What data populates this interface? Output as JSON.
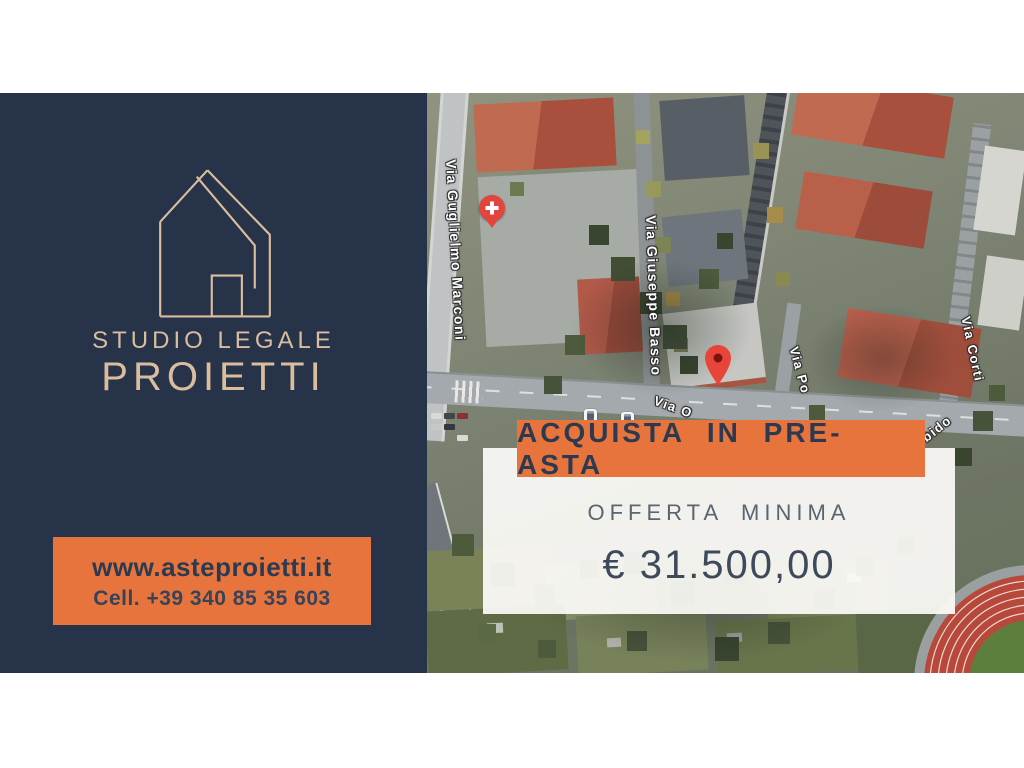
{
  "brand": {
    "title1": "STUDIO LEGALE",
    "title2": "PROIETTI",
    "website": "www.asteproietti.it",
    "phone": "Cell. +39 340 85 35 603"
  },
  "offer": {
    "banner": "ACQUISTA IN PRE-ASTA",
    "label": "OFFERTA MINIMA",
    "amount": "€ 31.500,00"
  },
  "map": {
    "type": "satellite",
    "street_labels": [
      {
        "text": "Via Guglielmo Marconi"
      },
      {
        "text": "Via Giuseppe Basso"
      },
      {
        "text": "Via Po"
      },
      {
        "text": "Via Corti"
      },
      {
        "text": "Via O"
      },
      {
        "text": "bido"
      }
    ],
    "markers": [
      {
        "icon": "hospital-pin"
      },
      {
        "icon": "property-pin"
      },
      {
        "icon": "bus-stop-icon"
      },
      {
        "icon": "bus-stop-icon"
      }
    ]
  },
  "colors": {
    "navy": "#263349",
    "orange": "#e6743c",
    "tan": "#d9bd9e",
    "pin_red": "#e8453a",
    "card_bg": "#fbfaf8"
  }
}
